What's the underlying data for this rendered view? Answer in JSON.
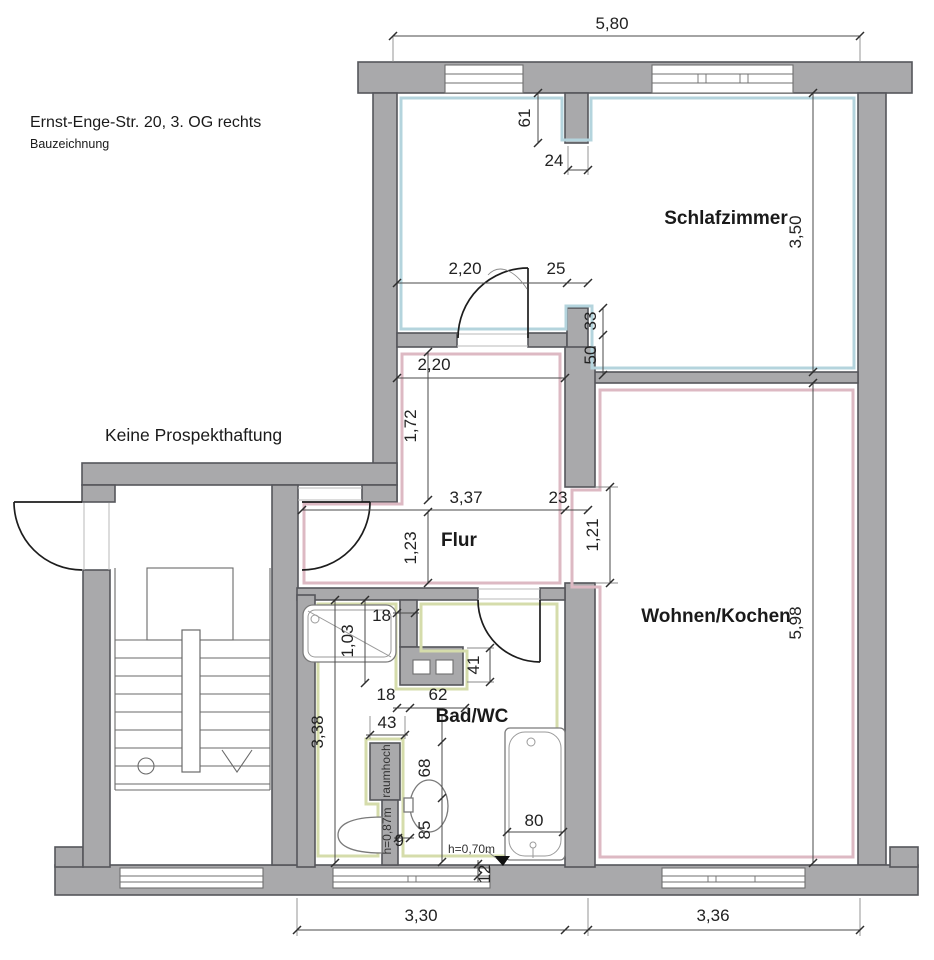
{
  "header": {
    "title": "Ernst-Enge-Str. 20, 3. OG rechts",
    "subtitle": "Bauzeichnung",
    "disclaimer": "Keine Prospekthaftung"
  },
  "rooms": {
    "bedroom": "Schlafzimmer",
    "living": "Wohnen/Kochen",
    "hallway": "Flur",
    "bathroom": "Bad/WC"
  },
  "dims": {
    "building_top": "5,80",
    "pier_depth": "61",
    "pier_width": "24",
    "bedroom_depth": "3,50",
    "bedroom_door_wall": "2,20",
    "door_jamb": "25",
    "step_a": "33",
    "step_b": "50",
    "hall_top_width": "2,20",
    "hall_upper_depth": "1,72",
    "hall_width": "3,37",
    "wall_thickness": "23",
    "hall_lower_depth": "1,23",
    "living_opening": "1,21",
    "living_depth": "5,98",
    "shower_edge": "18",
    "shower_length": "1,03",
    "duct_left": "18",
    "duct_width": "62",
    "duct_depth": "41",
    "bath_pier_width": "43",
    "bath_depth": "3,38",
    "wc_width": "68",
    "wc_depth": "85",
    "gap": "9",
    "tub_width": "80",
    "sill": "12",
    "bath_bottom_width": "3,30",
    "living_bottom_width": "3,36"
  },
  "labels": {
    "full_height": "raumhoch",
    "half_wall_height": "h=0,87m",
    "tub_height": "h=0,70m"
  }
}
